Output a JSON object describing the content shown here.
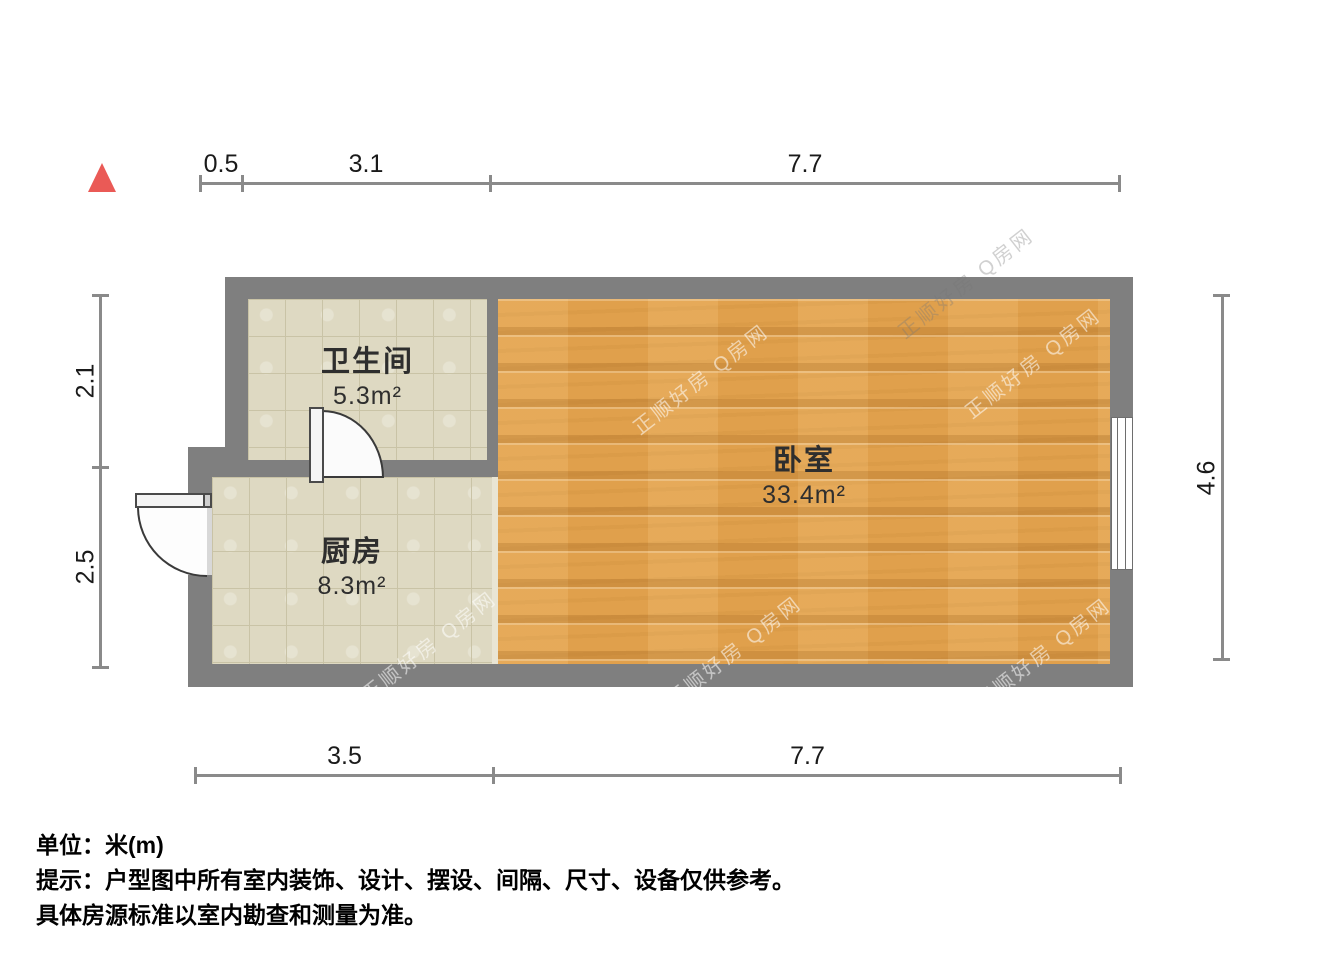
{
  "floorplan": {
    "rooms": [
      {
        "id": "bathroom",
        "name": "卫生间",
        "area": "5.3m²"
      },
      {
        "id": "kitchen",
        "name": "厨房",
        "area": "8.3m²"
      },
      {
        "id": "bedroom",
        "name": "卧室",
        "area": "33.4m²"
      }
    ],
    "dimensions": {
      "top": [
        "0.5",
        "3.1",
        "7.7"
      ],
      "bottom": [
        "3.5",
        "7.7"
      ],
      "left": [
        "2.1",
        "2.5"
      ],
      "right": [
        "4.6"
      ]
    },
    "watermark": "正顺好房 Q房网",
    "colors": {
      "wall": "#7f7f7f",
      "tile_floor": "#ded9c2",
      "wood_floor": "#e0a04c",
      "north_arrow": "#ea5a56",
      "dimension_line": "#8a8a8a"
    }
  },
  "footer": {
    "unit_line": "单位：米(m)",
    "tip_line1": "提示：户型图中所有室内装饰、设计、摆设、间隔、尺寸、设备仅供参考。",
    "tip_line2": "具体房源标准以室内勘查和测量为准。"
  }
}
